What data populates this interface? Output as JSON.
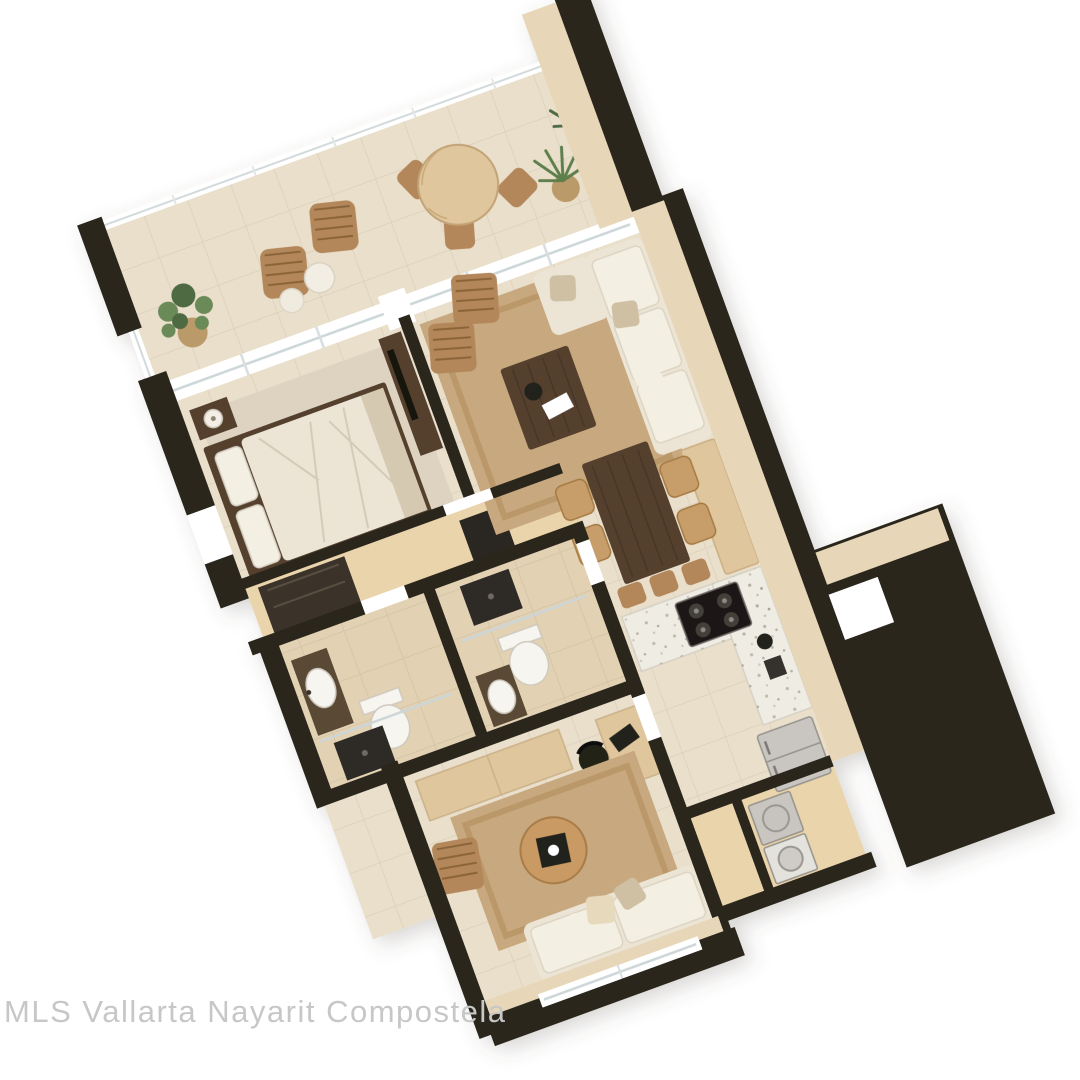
{
  "watermark": {
    "text": "MLS Vallarta Nayarit Compostela"
  },
  "colors": {
    "wall": "#29261f",
    "wall-face": "#e7d7b8",
    "floor-tile": "#e9dfca",
    "floor-wood": "#ead4ab",
    "floor-bath": "#e2d1b2",
    "rug": "#c8a87e",
    "rug-border": "#b18a58",
    "wood-dark": "#54402e",
    "wood-mid": "#b3875a",
    "wood-light": "#dfc69c",
    "fabric-cream": "#ece5d6",
    "fabric-cream-light": "#f4efe3",
    "fabric-taupe": "#cfc0a4",
    "terrazzo": "#efece4",
    "accent-dark": "#23201c",
    "appliance": "#c9c6c1",
    "appliance-edge": "#94918b",
    "plant-green": "#6a8a58",
    "plant-green-dark": "#4d6b42",
    "pot": "#bb9a6b",
    "watermark": "#c7c7c7"
  }
}
